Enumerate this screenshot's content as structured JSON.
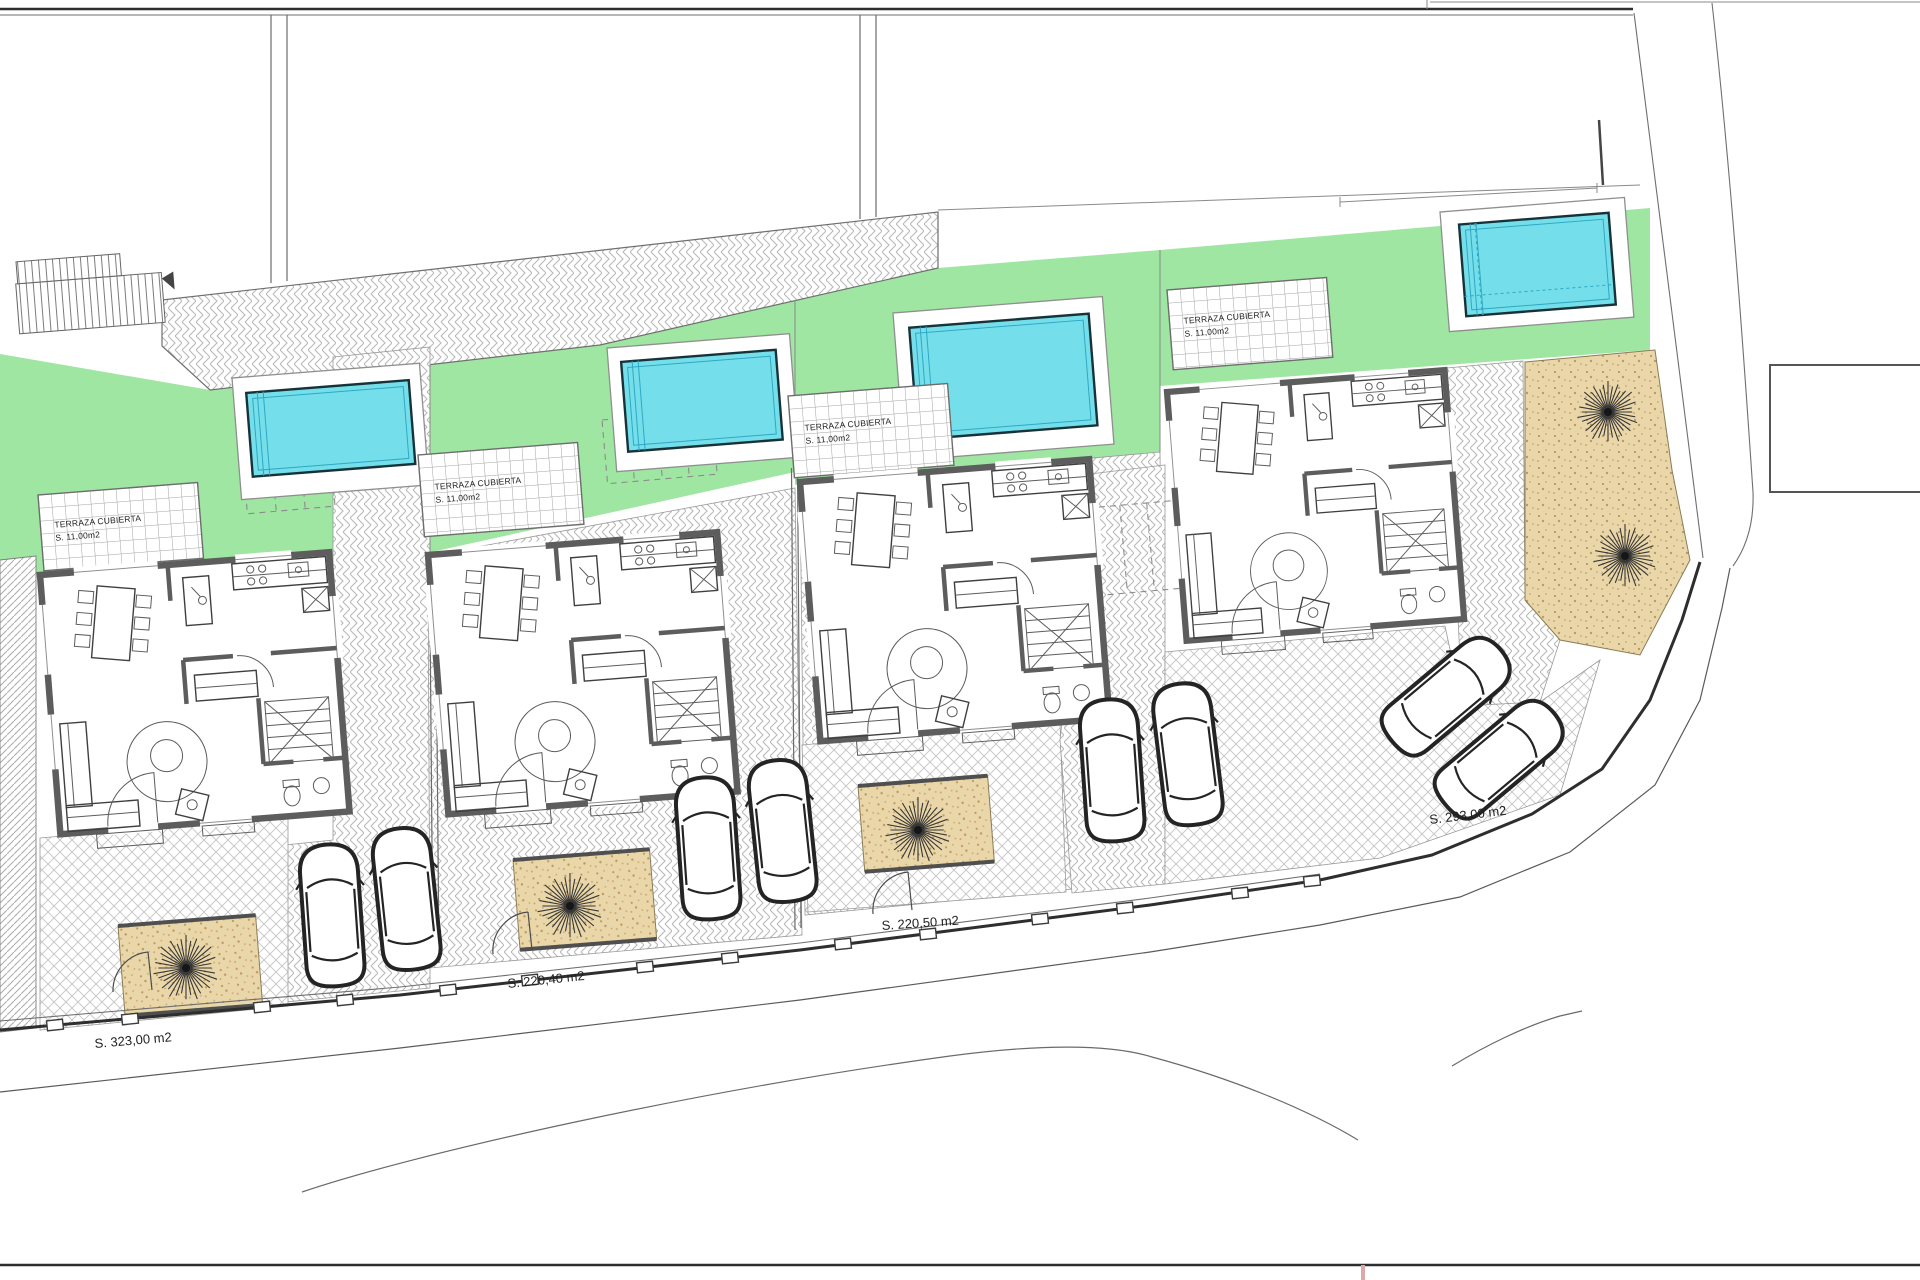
{
  "labels": {
    "plots": [
      {
        "text": "S. 323,00 m2"
      },
      {
        "text": "S. 220,40 m2"
      },
      {
        "text": "S. 220,50 m2"
      },
      {
        "text": "S. 293,00 m2"
      }
    ],
    "terrace_line1": "TERRAZA CUBIERTA",
    "terrace_line2": "S. 11,00m2"
  },
  "colors": {
    "lawn": "#9fe6a2",
    "water": "#74dfea",
    "waterline": "#2fa8c4",
    "poolborder": "#17333a",
    "sand": "#ead7a9",
    "sanddot": "#bf9760",
    "wall": "#5d5d5d",
    "furn": "#3f3f3f",
    "line": "#2e2e2e",
    "linesoft": "#6f6f6f",
    "label": "#1f1f1f",
    "pink": "#dfa8a8"
  },
  "trees": [
    {
      "cx": 186,
      "cy": 968,
      "r": 33
    },
    {
      "cx": 570,
      "cy": 906,
      "r": 33
    },
    {
      "cx": 918,
      "cy": 830,
      "r": 33
    },
    {
      "cx": 1608,
      "cy": 412,
      "r": 31
    },
    {
      "cx": 1625,
      "cy": 556,
      "r": 32
    }
  ],
  "fence_posts": [
    {
      "x": 55,
      "y": 1025
    },
    {
      "x": 130,
      "y": 1019
    },
    {
      "x": 262,
      "y": 1007
    },
    {
      "x": 345,
      "y": 1000
    },
    {
      "x": 448,
      "y": 990
    },
    {
      "x": 530,
      "y": 980
    },
    {
      "x": 645,
      "y": 967
    },
    {
      "x": 730,
      "y": 958
    },
    {
      "x": 843,
      "y": 944
    },
    {
      "x": 928,
      "y": 934
    },
    {
      "x": 1040,
      "y": 919
    },
    {
      "x": 1125,
      "y": 908
    },
    {
      "x": 1240,
      "y": 893
    },
    {
      "x": 1312,
      "y": 881
    }
  ]
}
